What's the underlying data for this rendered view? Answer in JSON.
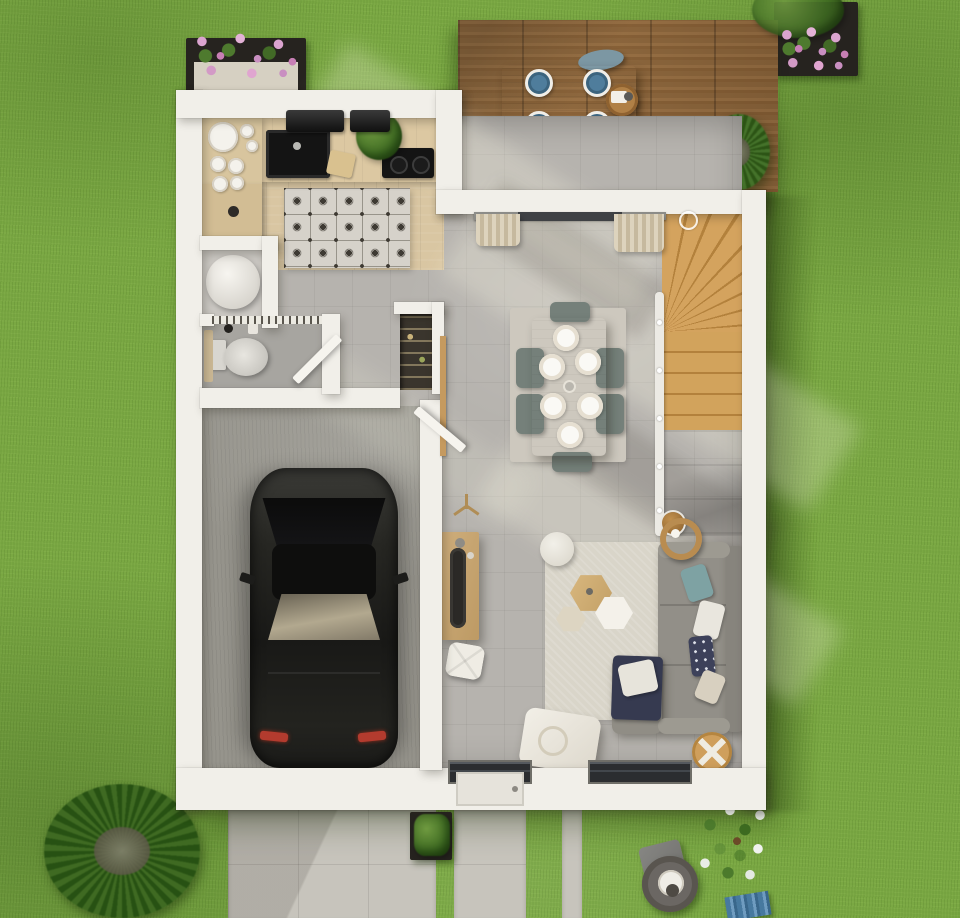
{
  "scene": {
    "kind": "3d-rendered-floor-plan",
    "view": "top-down",
    "level": "ground-floor"
  },
  "palette": {
    "grass": "#7aa843",
    "grass_shadow": "#3d5c1d",
    "wall": "#f1efe9",
    "deck_wood": "#8a6136",
    "kitchen_wood": "#d9c6a2",
    "stair_wood": "#cfa15a",
    "interior_floor": "#b6b3ae",
    "garage_floor": "#96948c",
    "tile_motif": "#3e3a33",
    "sofa_gray": "#928f88",
    "chair_green": "#75807a",
    "outdoor_chair_blue": "#7c97a3",
    "plate_blue": "#4f7d9c",
    "car_black": "#1c1c1a",
    "taillight_red": "#b33b2e",
    "flower_pink": "#c98fc1",
    "basket_wicker": "#cf9f5c",
    "window_glass": "#2b2d30",
    "paver": "#c7c4bc"
  },
  "areas": {
    "terrace": {
      "items": [
        "wood-deck",
        "outdoor-dining-table",
        "outdoor-chairs",
        "blue-plates",
        "serving-tray",
        "grass-plant",
        "towel"
      ],
      "plate_count": 4,
      "chair_count": 2
    },
    "kitchen": {
      "items": [
        "l-shaped-counter",
        "black-sink",
        "cooktop",
        "range-hood",
        "stacked-dishes",
        "cutting-board",
        "herb-plant",
        "cement-tile-rug"
      ]
    },
    "utility_closet": {
      "items": [
        "water-heater"
      ]
    },
    "wc": {
      "items": [
        "toilet",
        "shelf",
        "open-door"
      ]
    },
    "hall": {
      "items": [
        "pantry-shelves",
        "coat-stand",
        "console-table",
        "pouf"
      ]
    },
    "garage": {
      "items": [
        "car",
        "open-door"
      ],
      "car_color": "dark-gray"
    },
    "dining": {
      "items": [
        "wood-table",
        "chairs",
        "white-plates",
        "area-rug"
      ],
      "chair_count": 6,
      "plate_count": 6
    },
    "living": {
      "items": [
        "corner-sofa",
        "cushions",
        "hexagon-coffee-tables",
        "rug",
        "round-pouf",
        "floor-lamp",
        "wicker-basket",
        "lounge-chair",
        "sliding-glass-door",
        "curtains",
        "windows"
      ]
    },
    "stairs": {
      "items": [
        "winder-staircase",
        "white-railing",
        "newel-post"
      ]
    },
    "garden": {
      "items": [
        "lawn",
        "flower-box",
        "flower-pot",
        "palm-bush",
        "shrub-planter",
        "driveway",
        "walkway",
        "garden-chair",
        "garden-table",
        "blossom-tree",
        "blue-mat"
      ]
    }
  }
}
